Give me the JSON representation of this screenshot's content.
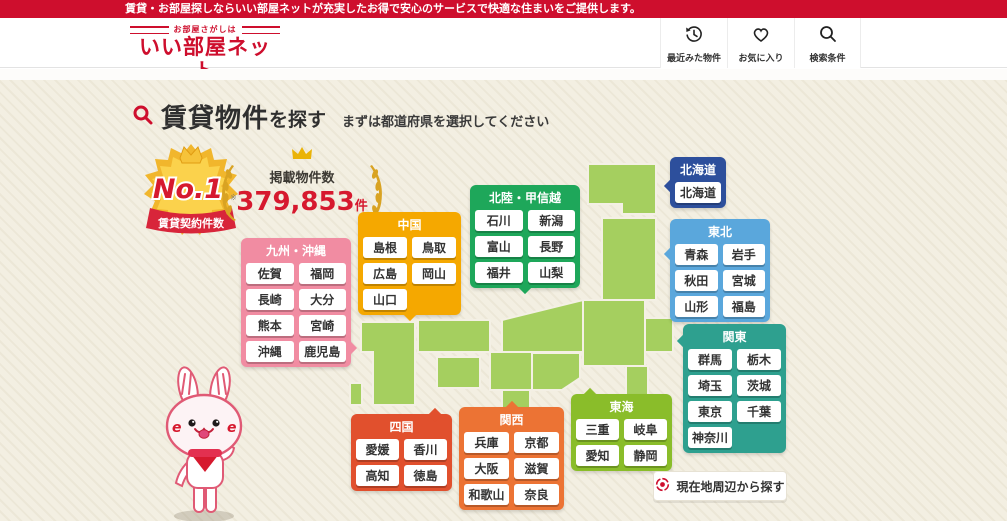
{
  "topbar": {
    "message": "賃貸・お部屋探しならいい部屋ネットが充実したお得で安心のサービスで快適な住まいをご提供します。"
  },
  "header": {
    "logo_tagline": "お部屋さがしは",
    "logo_name": "いい部屋ネット",
    "nav": [
      {
        "label": "最近みた物件",
        "icon": "history-icon"
      },
      {
        "label": "お気に入り",
        "icon": "heart-icon"
      },
      {
        "label": "検索条件",
        "icon": "search-icon"
      }
    ]
  },
  "hero": {
    "title_strong": "賃貸物件",
    "title_rest": "を探す",
    "subtitle": "まずは都道府県を選択してください",
    "badge": {
      "rank": "No.1",
      "note": "※",
      "ribbon": "賃貸契約件数"
    },
    "count": {
      "label": "掲載物件数",
      "value": "379,853",
      "unit": "件"
    }
  },
  "regions": [
    {
      "id": "hokkaido",
      "name": "北海道",
      "color": "#2d4f9c",
      "prefs": [
        "北海道"
      ]
    },
    {
      "id": "tohoku",
      "name": "東北",
      "color": "#5aa7dc",
      "prefs": [
        "青森",
        "岩手",
        "秋田",
        "宮城",
        "山形",
        "福島"
      ]
    },
    {
      "id": "kanto",
      "name": "関東",
      "color": "#2ea08f",
      "prefs": [
        "群馬",
        "栃木",
        "埼玉",
        "茨城",
        "東京",
        "千葉",
        "神奈川"
      ]
    },
    {
      "id": "hokuriku",
      "name": "北陸・甲信越",
      "color": "#1ea75a",
      "prefs": [
        "石川",
        "新潟",
        "富山",
        "長野",
        "福井",
        "山梨"
      ]
    },
    {
      "id": "chugoku",
      "name": "中国",
      "color": "#f5a800",
      "prefs": [
        "島根",
        "鳥取",
        "広島",
        "岡山",
        "山口"
      ]
    },
    {
      "id": "kyushu",
      "name": "九州・沖縄",
      "color": "#f18ca2",
      "prefs": [
        "佐賀",
        "福岡",
        "長崎",
        "大分",
        "熊本",
        "宮崎",
        "沖縄",
        "鹿児島"
      ]
    },
    {
      "id": "shikoku",
      "name": "四国",
      "color": "#e1502d",
      "prefs": [
        "愛媛",
        "香川",
        "高知",
        "徳島"
      ]
    },
    {
      "id": "kansai",
      "name": "関西",
      "color": "#ec7334",
      "prefs": [
        "兵庫",
        "京都",
        "大阪",
        "滋賀",
        "和歌山",
        "奈良"
      ]
    },
    {
      "id": "tokai",
      "name": "東海",
      "color": "#8abd2a",
      "prefs": [
        "三重",
        "岐阜",
        "愛知",
        "静岡"
      ]
    }
  ],
  "geo_button": {
    "label": "現在地周辺から探す",
    "icon": "target-icon"
  },
  "colors": {
    "accent_red": "#ce0e2d",
    "number_red": "#d6192e",
    "background_beige": "#f3efe2",
    "map_green": "#a5cf5f",
    "badge_gold": "#f1b62c"
  }
}
